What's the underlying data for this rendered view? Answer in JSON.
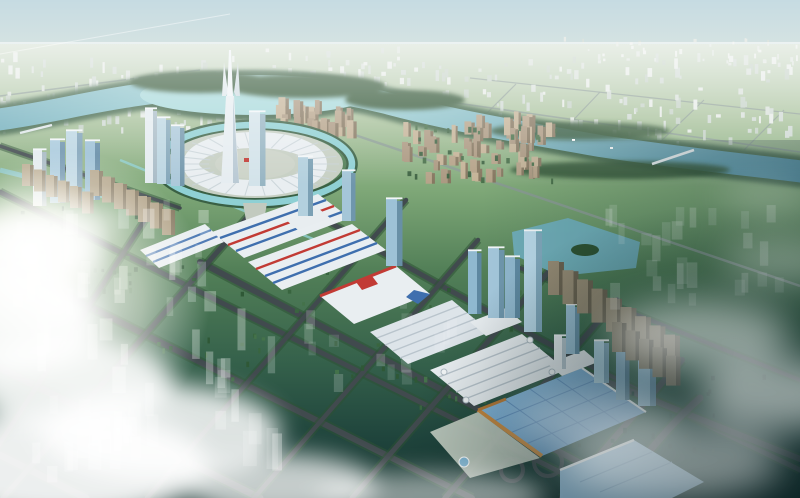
{
  "meta": {
    "description": "Aerial bird's-eye architectural rendering of a planned city district: a winding teal river, a circular landmark plaza with a twin-prong supertall spire, a diagonal commercial expo axis with white big-box halls and glass towers, green development parcels in a diamond road grid, translucent future-phase buildings, and soft clouds over the foreground"
  },
  "palette": {
    "sky_top": "#c6dbe2",
    "sky_low": "#e0e9e3",
    "plain_light": "#cfdccc",
    "ground_1": "#a9c29c",
    "ground_2": "#7fa878",
    "ground_3": "#527f57",
    "ground_4": "#35614b",
    "ground_5": "#1f443c",
    "ground_6": "#16332f",
    "river_light": "#a5d8da",
    "river_mid": "#6fadbb",
    "river_deep": "#49899f",
    "bank_green": "#3a6044",
    "forest": "#2e5232",
    "road": "#414a4e",
    "road_distant": "#8a9a94",
    "verge": "#2d5134",
    "roof_white": "#e9eef1",
    "roof_ridge": "#b9c4cc",
    "stripe_blue": "#3f6fae",
    "stripe_red": "#c23b35",
    "hall_light": "#8fc0e2",
    "hall_mid": "#5e93c2",
    "hall_line": "#5586b8",
    "orange_trim": "#c9893f",
    "plaza": "#c6cfc3",
    "cloud": "#ffffff"
  },
  "scene": {
    "landmark": {
      "cx": 255,
      "cy": 164,
      "ribs": 26,
      "r1x": 46,
      "r1y": 17,
      "r2x": 84,
      "r2y": 32
    },
    "towers": [
      {
        "x": 33,
        "w": 9,
        "t": 150,
        "b": 206,
        "c": "#e3ebef",
        "s": "#a4b7c1"
      },
      {
        "x": 50,
        "w": 10,
        "t": 140,
        "b": 203,
        "c": "#a9cadd",
        "s": "#6d93ad"
      },
      {
        "x": 66,
        "w": 11,
        "t": 131,
        "b": 201,
        "c": "#bcd6e3",
        "s": "#7fa2b8"
      },
      {
        "x": 85,
        "w": 10,
        "t": 141,
        "b": 200,
        "c": "#9cc0d6",
        "s": "#628aa5"
      },
      {
        "x": 145,
        "w": 8,
        "t": 109,
        "b": 183,
        "c": "#e4ecf0",
        "s": "#a9bcc7"
      },
      {
        "x": 157,
        "w": 9,
        "t": 118,
        "b": 184,
        "c": "#bcd6e2",
        "s": "#84a7ba"
      },
      {
        "x": 171,
        "w": 9,
        "t": 126,
        "b": 186,
        "c": "#acc9da",
        "s": "#7397ac"
      },
      {
        "x": 249,
        "w": 11,
        "t": 112,
        "b": 186,
        "c": "#d3e3ea",
        "s": "#97b5c3"
      },
      {
        "x": 298,
        "w": 10,
        "t": 157,
        "b": 216,
        "c": "#b3d0de",
        "s": "#7ba0b4"
      },
      {
        "x": 342,
        "w": 9,
        "t": 171,
        "b": 221,
        "c": "#a5c6d8",
        "s": "#6f96ac"
      },
      {
        "x": 386,
        "w": 11,
        "t": 199,
        "b": 266,
        "c": "#9dc2d6",
        "s": "#6890a6"
      },
      {
        "x": 468,
        "w": 9,
        "t": 251,
        "b": 314,
        "c": "#8fb8cf",
        "s": "#5d87a0"
      },
      {
        "x": 488,
        "w": 11,
        "t": 248,
        "b": 318,
        "c": "#a3c6da",
        "s": "#6f96ac"
      },
      {
        "x": 505,
        "w": 10,
        "t": 257,
        "b": 318,
        "c": "#8fb6cc",
        "s": "#5e88a0"
      },
      {
        "x": 524,
        "w": 12,
        "t": 231,
        "b": 332,
        "c": "#b7d6e6",
        "s": "#7fa6ba"
      },
      {
        "x": 554,
        "w": 8,
        "t": 336,
        "b": 369,
        "c": "#e9eef1",
        "s": "#b7c6ce"
      },
      {
        "x": 566,
        "w": 9,
        "t": 305,
        "b": 354,
        "c": "#9cc0d4",
        "s": "#6a92a8"
      },
      {
        "x": 594,
        "w": 10,
        "t": 341,
        "b": 383,
        "c": "#add0e0",
        "s": "#779fb4"
      },
      {
        "x": 616,
        "w": 9,
        "t": 350,
        "b": 400,
        "c": "#7fa8c0",
        "s": "#4f7890"
      },
      {
        "x": 638,
        "w": 12,
        "t": 337,
        "b": 406,
        "c": "#8fb9d2",
        "s": "#5d89a4"
      }
    ],
    "slab_rows": [
      {
        "x": 548,
        "y": 295,
        "dx": 14.5,
        "dy": 9.2,
        "n": 9,
        "w": 11,
        "h": 34,
        "c": "#978b74",
        "s": "#6b6250"
      },
      {
        "x": 612,
        "y": 352,
        "dx": 13.5,
        "dy": 8.4,
        "n": 5,
        "w": 10,
        "h": 30,
        "c": "#867b66",
        "s": "#5d5546"
      },
      {
        "x": 90,
        "y": 196,
        "dx": 12,
        "dy": 6.5,
        "n": 7,
        "w": 9,
        "h": 26,
        "c": "#b3a489",
        "s": "#8a7d66"
      },
      {
        "x": 22,
        "y": 186,
        "dx": 12,
        "dy": 5.5,
        "n": 6,
        "w": 8,
        "h": 22,
        "c": "#b9ab90",
        "s": "#90836b"
      }
    ],
    "clusters": [
      {
        "layer": "gDistantCity",
        "name": "distant-city-left",
        "x": 0,
        "y": 62,
        "w": 252,
        "h": 72,
        "n": 105,
        "bw": [
          2,
          5
        ],
        "bh": [
          3,
          11
        ],
        "colors": [
          "#e6ebe7",
          "#d8e0da",
          "#cfd9d3",
          "#c4d1c6"
        ]
      },
      {
        "layer": "gDistantCity",
        "name": "distant-city-center",
        "x": 250,
        "y": 50,
        "w": 175,
        "h": 38,
        "n": 40,
        "bw": [
          2,
          5
        ],
        "bh": [
          3,
          9
        ],
        "colors": [
          "#e6ebe7",
          "#d8e0da",
          "#cfd9d3"
        ]
      },
      {
        "layer": "gDistantCity",
        "name": "distant-city-right",
        "x": 428,
        "y": 62,
        "w": 372,
        "h": 84,
        "n": 125,
        "bw": [
          2,
          5
        ],
        "bh": [
          3,
          11
        ],
        "colors": [
          "#e6ebe7",
          "#d8e0da",
          "#cfd9d3",
          "#c4d1c6"
        ]
      },
      {
        "layer": "gDistantCity",
        "name": "distant-city-far-right",
        "x": 560,
        "y": 40,
        "w": 240,
        "h": 26,
        "n": 40,
        "bw": [
          1.5,
          3.5
        ],
        "bh": [
          2,
          6
        ],
        "colors": [
          "#e8ece8",
          "#dde4de"
        ]
      },
      {
        "layer": "gTan",
        "name": "residential-ne-landmark",
        "x": 268,
        "y": 112,
        "w": 82,
        "h": 30,
        "n": 26,
        "bw": [
          4,
          7
        ],
        "bh": [
          10,
          20
        ],
        "colors": [
          "#c4b296",
          "#b5a288",
          "#ab9880"
        ],
        "shade": "#85765f"
      },
      {
        "layer": "gTan",
        "name": "residential-right-large",
        "x": 402,
        "y": 126,
        "w": 155,
        "h": 58,
        "n": 52,
        "bw": [
          4,
          7
        ],
        "bh": [
          9,
          20
        ],
        "colors": [
          "#c4b296",
          "#b5a288",
          "#ab9880"
        ],
        "shade": "#85765f"
      },
      {
        "layer": "gTan",
        "name": "residential-zone-trees",
        "x": 400,
        "y": 128,
        "w": 160,
        "h": 58,
        "n": 30,
        "bw": [
          2,
          4
        ],
        "bh": [
          3,
          6
        ],
        "colors": [
          "#49704a",
          "#3e6342"
        ]
      },
      {
        "layer": "gParcelTrees",
        "name": "parcel-trees-mid",
        "x": 150,
        "y": 262,
        "w": 370,
        "h": 150,
        "n": 55,
        "bw": [
          2,
          4
        ],
        "bh": [
          3,
          6
        ],
        "colors": [
          "#39653f",
          "#2f5836",
          "#44724a"
        ]
      },
      {
        "layer": "gParcelTrees",
        "name": "parcel-trees-left",
        "x": 0,
        "y": 210,
        "w": 150,
        "h": 110,
        "n": 35,
        "bw": [
          2,
          4
        ],
        "bh": [
          3,
          6
        ],
        "colors": [
          "#3c6a43",
          "#32593a"
        ]
      },
      {
        "layer": "gParcelTrees",
        "name": "parcel-trees-right-dark",
        "x": 560,
        "y": 380,
        "w": 220,
        "h": 90,
        "n": 22,
        "bw": [
          2,
          4
        ],
        "bh": [
          3,
          6
        ],
        "colors": [
          "#1d3b33",
          "#234438"
        ]
      },
      {
        "layer": "gGhost",
        "name": "ghost-block-left-upper",
        "x": 8,
        "y": 218,
        "w": 200,
        "h": 100,
        "n": 30,
        "bw": [
          6,
          12
        ],
        "bh": [
          12,
          30
        ],
        "colors": [
          "rgba(255,255,255,0.30)",
          "rgba(240,248,250,0.24)",
          "rgba(255,255,255,0.18)"
        ]
      },
      {
        "layer": "gGhost",
        "name": "ghost-block-left-lower",
        "x": 30,
        "y": 335,
        "w": 250,
        "h": 140,
        "n": 34,
        "bw": [
          7,
          14
        ],
        "bh": [
          18,
          42
        ],
        "colors": [
          "rgba(255,255,255,0.30)",
          "rgba(244,250,252,0.22)",
          "rgba(255,255,255,0.16)"
        ]
      },
      {
        "layer": "gGhost",
        "name": "ghost-block-right",
        "x": 598,
        "y": 218,
        "w": 190,
        "h": 100,
        "n": 26,
        "bw": [
          6,
          11
        ],
        "bh": [
          12,
          28
        ],
        "colors": [
          "rgba(255,255,255,0.22)",
          "rgba(240,248,250,0.16)"
        ]
      },
      {
        "layer": "gGhost",
        "name": "ghost-block-mid",
        "x": 300,
        "y": 300,
        "w": 165,
        "h": 95,
        "n": 14,
        "bw": [
          6,
          11
        ],
        "bh": [
          12,
          26
        ],
        "colors": [
          "rgba(255,255,255,0.18)",
          "rgba(244,250,252,0.13)"
        ]
      },
      {
        "layer": "gGhost",
        "name": "ghost-block-bottom-left",
        "x": 0,
        "y": 432,
        "w": 170,
        "h": 55,
        "n": 10,
        "bw": [
          8,
          14
        ],
        "bh": [
          16,
          30
        ],
        "colors": [
          "rgba(255,255,255,0.25)"
        ]
      }
    ],
    "roads": {
      "main": [
        {
          "d": "M300,205 C420,276 540,340 660,402 L800,470",
          "w": 5
        },
        {
          "d": "M200,262 C330,330 460,398 590,468 L640,498",
          "w": 6
        },
        {
          "d": "M0,192 L612,498",
          "w": 5
        },
        {
          "d": "M0,262 L472,498",
          "w": 6
        },
        {
          "d": "M0,368 L260,498",
          "w": 7
        },
        {
          "d": "M0,455 L86,498",
          "w": 7
        },
        {
          "d": "M0,146 L180,208",
          "w": 3.5
        },
        {
          "d": "M540,355 L800,459",
          "w": 6
        },
        {
          "d": "M520,268 L800,380",
          "w": 4
        },
        {
          "d": "M3,498 L266,196",
          "w": 5
        },
        {
          "d": "M147,498 L406,200",
          "w": 4.5
        },
        {
          "d": "M254,498 L478,240",
          "w": 4.5
        },
        {
          "d": "M352,498 L550,270",
          "w": 5
        },
        {
          "d": "M445,498 L617,300",
          "w": 5.5
        },
        {
          "d": "M562,498 L682,360",
          "w": 6
        },
        {
          "d": "M615,498 Q655,438 700,398",
          "w": 7
        },
        {
          "d": "M-24,480 L150,212",
          "w": 4.5
        }
      ],
      "distant": [
        {
          "d": "M352,134 L800,286",
          "w": 2.5
        },
        {
          "d": "M408,96 L800,152",
          "w": 1.6
        },
        {
          "d": "M470,78 L800,114",
          "w": 1.2
        },
        {
          "d": "M560,134 L600,92",
          "w": 1.2
        },
        {
          "d": "M660,142 L704,100",
          "w": 1.2
        },
        {
          "d": "M744,150 L784,110",
          "w": 1.2
        },
        {
          "d": "M480,120 L516,84",
          "w": 1.2
        },
        {
          "d": "M0,96 L200,70",
          "w": 1.4
        }
      ]
    }
  }
}
